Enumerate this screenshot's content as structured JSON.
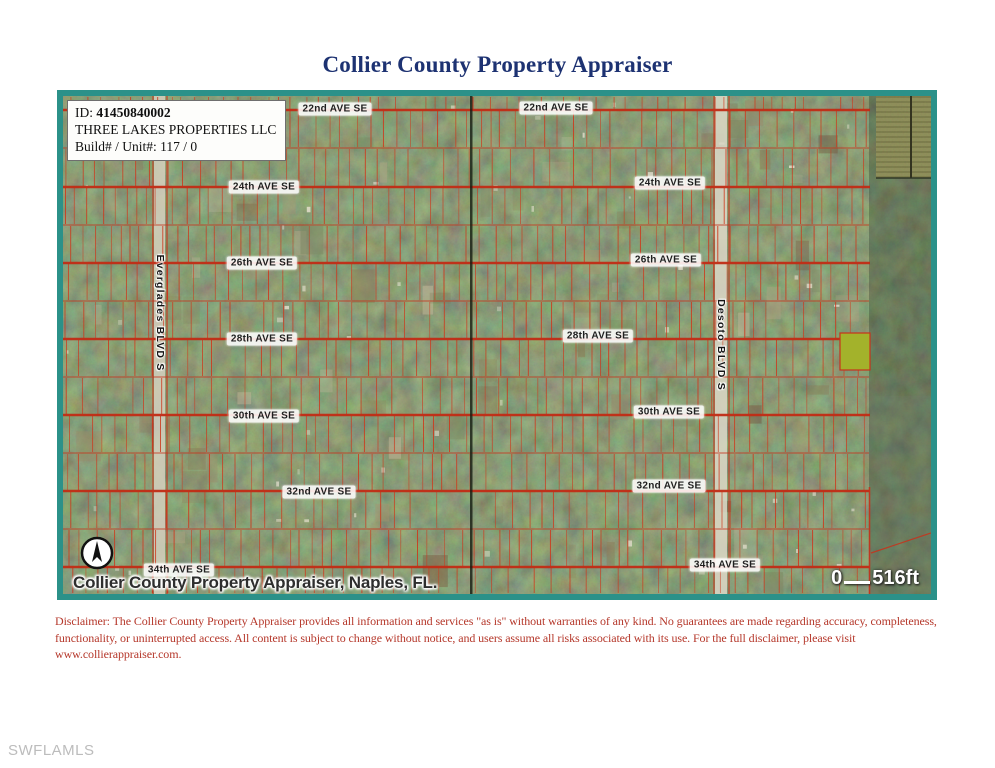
{
  "page": {
    "title": "Collier County Property Appraiser",
    "watermark": "SWFLAMLS"
  },
  "colors": {
    "border_teal": "#2b9189",
    "grid_red": "#c8321b",
    "title_navy": "#1d3272",
    "disclaimer_red": "#b5372a",
    "highlight_green": "#a3b22b",
    "watermark_gray": "#bcbcbc"
  },
  "map": {
    "info_box": {
      "id_label": "ID:",
      "id_value": "41450840002",
      "owner": "THREE LAKES PROPERTIES LLC",
      "build_unit": "Build# / Unit#: 117 / 0"
    },
    "caption": "Collier County Property Appraiser, Naples, FL.",
    "scale": {
      "zero": "0",
      "distance": "516ft"
    },
    "avenue_labels": [
      {
        "text": "22nd AVE SE",
        "x": 272,
        "y": 13
      },
      {
        "text": "24th AVE SE",
        "x": 201,
        "y": 91
      },
      {
        "text": "26th AVE SE",
        "x": 199,
        "y": 167
      },
      {
        "text": "28th AVE SE",
        "x": 199,
        "y": 243
      },
      {
        "text": "30th AVE SE",
        "x": 201,
        "y": 320
      },
      {
        "text": "32nd AVE SE",
        "x": 256,
        "y": 396
      },
      {
        "text": "34th AVE SE",
        "x": 116,
        "y": 474
      },
      {
        "text": "22nd AVE SE",
        "x": 493,
        "y": 12
      },
      {
        "text": "24th AVE SE",
        "x": 607,
        "y": 87
      },
      {
        "text": "26th AVE SE",
        "x": 603,
        "y": 164
      },
      {
        "text": "28th AVE SE",
        "x": 535,
        "y": 240
      },
      {
        "text": "30th AVE SE",
        "x": 606,
        "y": 316
      },
      {
        "text": "32nd AVE SE",
        "x": 606,
        "y": 390
      },
      {
        "text": "34th AVE SE",
        "x": 662,
        "y": 469
      }
    ],
    "blvd_labels": [
      {
        "text": "Everglades BLVD S",
        "x": 97,
        "y": 217
      },
      {
        "text": "Desoto BLVD S",
        "x": 658,
        "y": 249
      }
    ]
  },
  "disclaimer": {
    "lines": [
      "Disclaimer: The Collier County Property Appraiser provides all information and services \"as is\" without warranties of any kind. No guarantees are made regarding accuracy, completeness,",
      "functionality, or uninterrupted access. All content is subject to change without notice, and users assume all risks associated with its use. For the full disclaimer, please visit",
      "www.collierappraiser.com."
    ]
  }
}
